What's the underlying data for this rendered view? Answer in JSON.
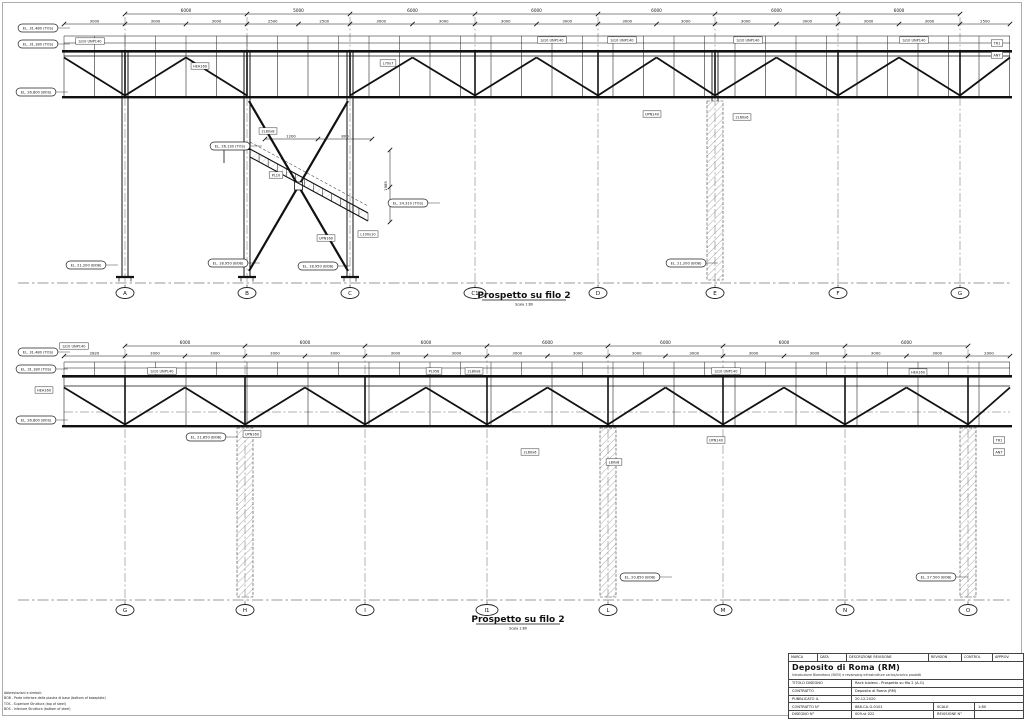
{
  "sheet": {
    "revision_header": {
      "marca": "MARCA",
      "data": "DATA",
      "descrizione": "DESCRIZIONE REVISIONE",
      "revision": "REVISION",
      "control": "CONTROL",
      "approv": "APPROV."
    },
    "project_title": "Deposito di Roma (RM)",
    "project_subtitle": "Introduzione Biometano (BIO5) e revamping infrastrutture carico/scarico prodotti",
    "rows": [
      {
        "label": "TITOLO DISEGNO",
        "value": "Rack tubiero - Prospetto su filo 2 (A-G)"
      },
      {
        "label": "CONTRATTO",
        "value": "Deposito di Roma (RM)"
      },
      {
        "label": "PUBBLICATO IL",
        "value": "20.12.2020"
      },
      {
        "label": "CONTRATTO N°",
        "value": "888-CA-G-0101",
        "label2": "SCALE",
        "value2": "1:80"
      },
      {
        "label": "DISEGNO N°",
        "value": "009-st 022",
        "label2": "REVISIONE N°",
        "value2": ""
      }
    ]
  },
  "notes": {
    "title": "Abbreviazioni e simboli:",
    "lines": [
      "BOB - Parte inferiore della piastra di base (bottom of baseplate)",
      "TOS - Superiore Struttura (top of steel)",
      "BOS - Inferiore Struttura (bottom of steel)"
    ]
  },
  "views": [
    {
      "id": "view-top",
      "title": "Prospetto su filo 2",
      "scale_note": "Scala 1:80",
      "grid_labels": [
        "A",
        "B",
        "C",
        "C1",
        "D",
        "E",
        "F",
        "G"
      ],
      "grid_x": [
        125,
        247,
        350,
        475,
        598,
        715,
        838,
        960
      ],
      "span_dims": [
        "6000",
        "5000",
        "6000",
        "6000",
        "6000",
        "6000",
        "6000"
      ],
      "minor_dims": [
        "3000",
        "3000",
        "3000",
        "2500",
        "2500",
        "3000",
        "3000",
        "3000",
        "3000",
        "3000",
        "3000",
        "3000",
        "3000",
        "3000",
        "3000",
        "2500"
      ],
      "detail_dims": [
        "1200",
        "800",
        "1985"
      ],
      "elevation_tags": [
        {
          "text": "EL. 31.480 (TOS)",
          "x": 38,
          "y": 28
        },
        {
          "text": "EL. 31.180 (TOS)",
          "x": 38,
          "y": 44
        },
        {
          "text": "EL. 26.800 (BOS)",
          "x": 36,
          "y": 92
        },
        {
          "text": "EL. 26.130 (TOS)",
          "x": 230,
          "y": 146
        },
        {
          "text": "EL. 24.310 (TOS)",
          "x": 408,
          "y": 203
        },
        {
          "text": "EL. 21.200 (BOB)",
          "x": 86,
          "y": 265
        },
        {
          "text": "EL. 18.950 (BOB)",
          "x": 228,
          "y": 263
        },
        {
          "text": "EL. 18.950 (BOB)",
          "x": 318,
          "y": 266
        },
        {
          "text": "EL. 21.200 (BOB)",
          "x": 686,
          "y": 263
        }
      ],
      "member_tags": [
        {
          "text": "S/10 UNP140",
          "x": 90,
          "y": 41
        },
        {
          "text": "HEA160",
          "x": 200,
          "y": 66
        },
        {
          "text": "L70x7",
          "x": 388,
          "y": 63
        },
        {
          "text": "S/10 UNP140",
          "x": 552,
          "y": 40
        },
        {
          "text": "S/10 UNP140",
          "x": 622,
          "y": 40
        },
        {
          "text": "S/10 UNP140",
          "x": 748,
          "y": 40
        },
        {
          "text": "S/10 UNP140",
          "x": 914,
          "y": 40
        },
        {
          "text": "UPN140",
          "x": 652,
          "y": 114
        },
        {
          "text": "2L60x6",
          "x": 742,
          "y": 117
        },
        {
          "text": "TR1",
          "x": 997,
          "y": 43
        },
        {
          "text": "AN7",
          "x": 997,
          "y": 55
        },
        {
          "text": "2L80x8",
          "x": 268,
          "y": 131
        },
        {
          "text": "PL10",
          "x": 276,
          "y": 175
        },
        {
          "text": "UPN160",
          "x": 326,
          "y": 238
        },
        {
          "text": "L100x10",
          "x": 368,
          "y": 234
        }
      ],
      "geo": {
        "dim1": 14,
        "dim2": 24,
        "rail0": 36,
        "rail1": 43,
        "deck": 50,
        "chord2": 56,
        "bot": 96,
        "ground": 283,
        "bubble": 293,
        "x0": 64,
        "x1": 1010,
        "post_dx": 30.5,
        "truss_dx": 30.5,
        "cols": [
          125,
          247,
          350
        ],
        "hatched": [
          715
        ],
        "hatch_top": 101,
        "caps": true,
        "xb": [
          247,
          350
        ],
        "stair": true,
        "title": {
          "x": 524,
          "y": 298
        }
      }
    },
    {
      "id": "view-bottom",
      "title": "Prospetto su filo 2",
      "scale_note": "Scala 1:80",
      "grid_labels": [
        "G",
        "H",
        "I",
        "I1",
        "L",
        "M",
        "N",
        "O"
      ],
      "grid_x": [
        125,
        245,
        365,
        487,
        608,
        723,
        845,
        968
      ],
      "span_dims": [
        "6000",
        "6000",
        "6000",
        "6000",
        "6000",
        "6000",
        "6000"
      ],
      "minor_dims": [
        "2820",
        "3000",
        "3000",
        "3000",
        "3000",
        "3000",
        "3000",
        "3000",
        "3000",
        "3000",
        "3000",
        "3000",
        "3000",
        "3000",
        "3000",
        "2000"
      ],
      "detail_dims": [],
      "elevation_tags": [
        {
          "text": "EL. 31.480 (TOS)",
          "x": 38,
          "y": 352
        },
        {
          "text": "EL. 31.180 (TOS)",
          "x": 36,
          "y": 369
        },
        {
          "text": "EL. 26.800 (BOS)",
          "x": 36,
          "y": 420
        },
        {
          "text": "EL. 21.850 (BOB)",
          "x": 206,
          "y": 437
        },
        {
          "text": "EL. 20.850 (BOB)",
          "x": 640,
          "y": 577
        },
        {
          "text": "EL. 27.500 (BOB)",
          "x": 936,
          "y": 577
        }
      ],
      "member_tags": [
        {
          "text": "S/10 UNP140",
          "x": 74,
          "y": 346
        },
        {
          "text": "HEA160",
          "x": 44,
          "y": 390
        },
        {
          "text": "S/10 UNP140",
          "x": 162,
          "y": 371
        },
        {
          "text": "PL958",
          "x": 434,
          "y": 371
        },
        {
          "text": "2L80x8",
          "x": 474,
          "y": 371
        },
        {
          "text": "S/10 UNP140",
          "x": 726,
          "y": 371
        },
        {
          "text": "HEA160",
          "x": 918,
          "y": 372
        },
        {
          "text": "UPN160",
          "x": 252,
          "y": 434
        },
        {
          "text": "2L60x6",
          "x": 530,
          "y": 452
        },
        {
          "text": "L80x8",
          "x": 614,
          "y": 462
        },
        {
          "text": "UPN140",
          "x": 716,
          "y": 440
        },
        {
          "text": "TR1",
          "x": 999,
          "y": 440
        },
        {
          "text": "AN7",
          "x": 999,
          "y": 452
        }
      ],
      "geo": {
        "dim1": 346,
        "dim2": 356,
        "rail0": 362,
        "rail1": 368,
        "deck": 375,
        "chord2": 386,
        "bot": 425,
        "ground": 600,
        "bubble": 610,
        "x0": 64,
        "x1": 1010,
        "post_dx": 30.5,
        "truss_dx": 61,
        "cols": [],
        "hatched": [
          245,
          608,
          968
        ],
        "hatch_top": 428,
        "caps": false,
        "pipe_cl": 412,
        "stair": false,
        "title": {
          "x": 518,
          "y": 622
        }
      }
    }
  ]
}
